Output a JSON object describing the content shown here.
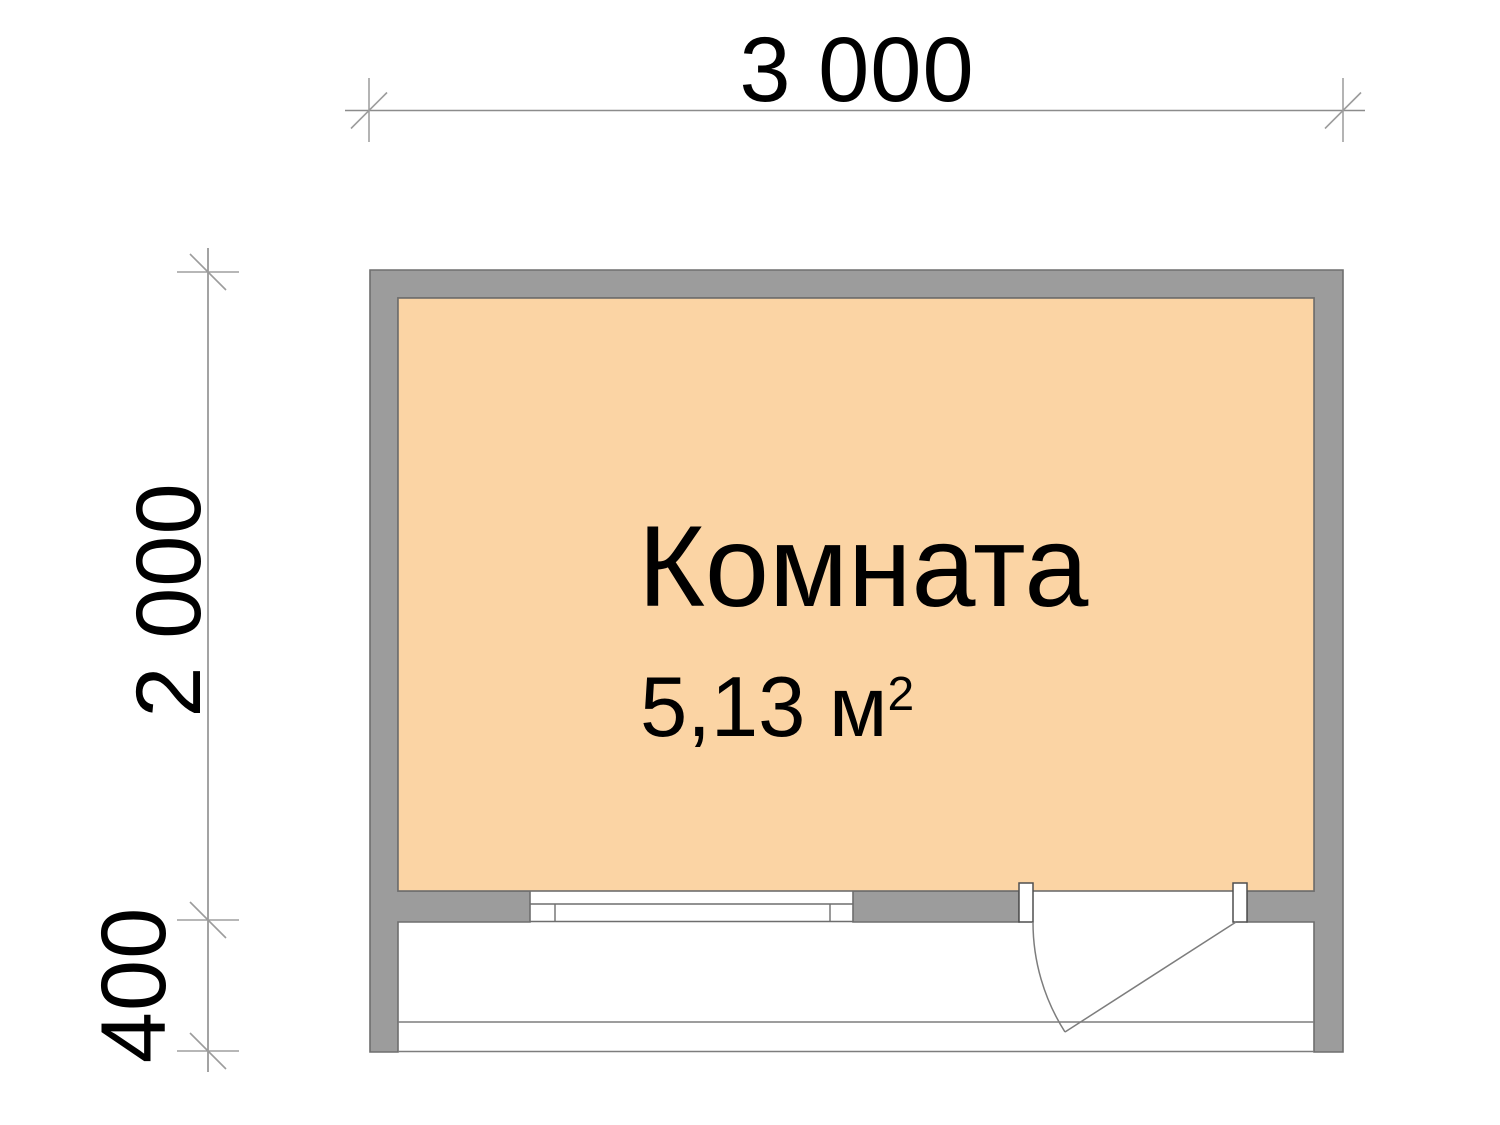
{
  "drawing": {
    "type": "floor-plan",
    "room": {
      "name": "Комната",
      "area_label": "5,13 м",
      "area_exponent": "2"
    },
    "dimensions": {
      "width": "3 000",
      "height": "2 000",
      "porch_depth": "400"
    },
    "colors": {
      "wall_fill": "#9C9C9C",
      "wall_outline": "#6E6E6E",
      "room_fill": "#FBD4A4",
      "dimension_line": "#8C8C8C",
      "text": "#000000",
      "background": "#FFFFFF"
    }
  }
}
